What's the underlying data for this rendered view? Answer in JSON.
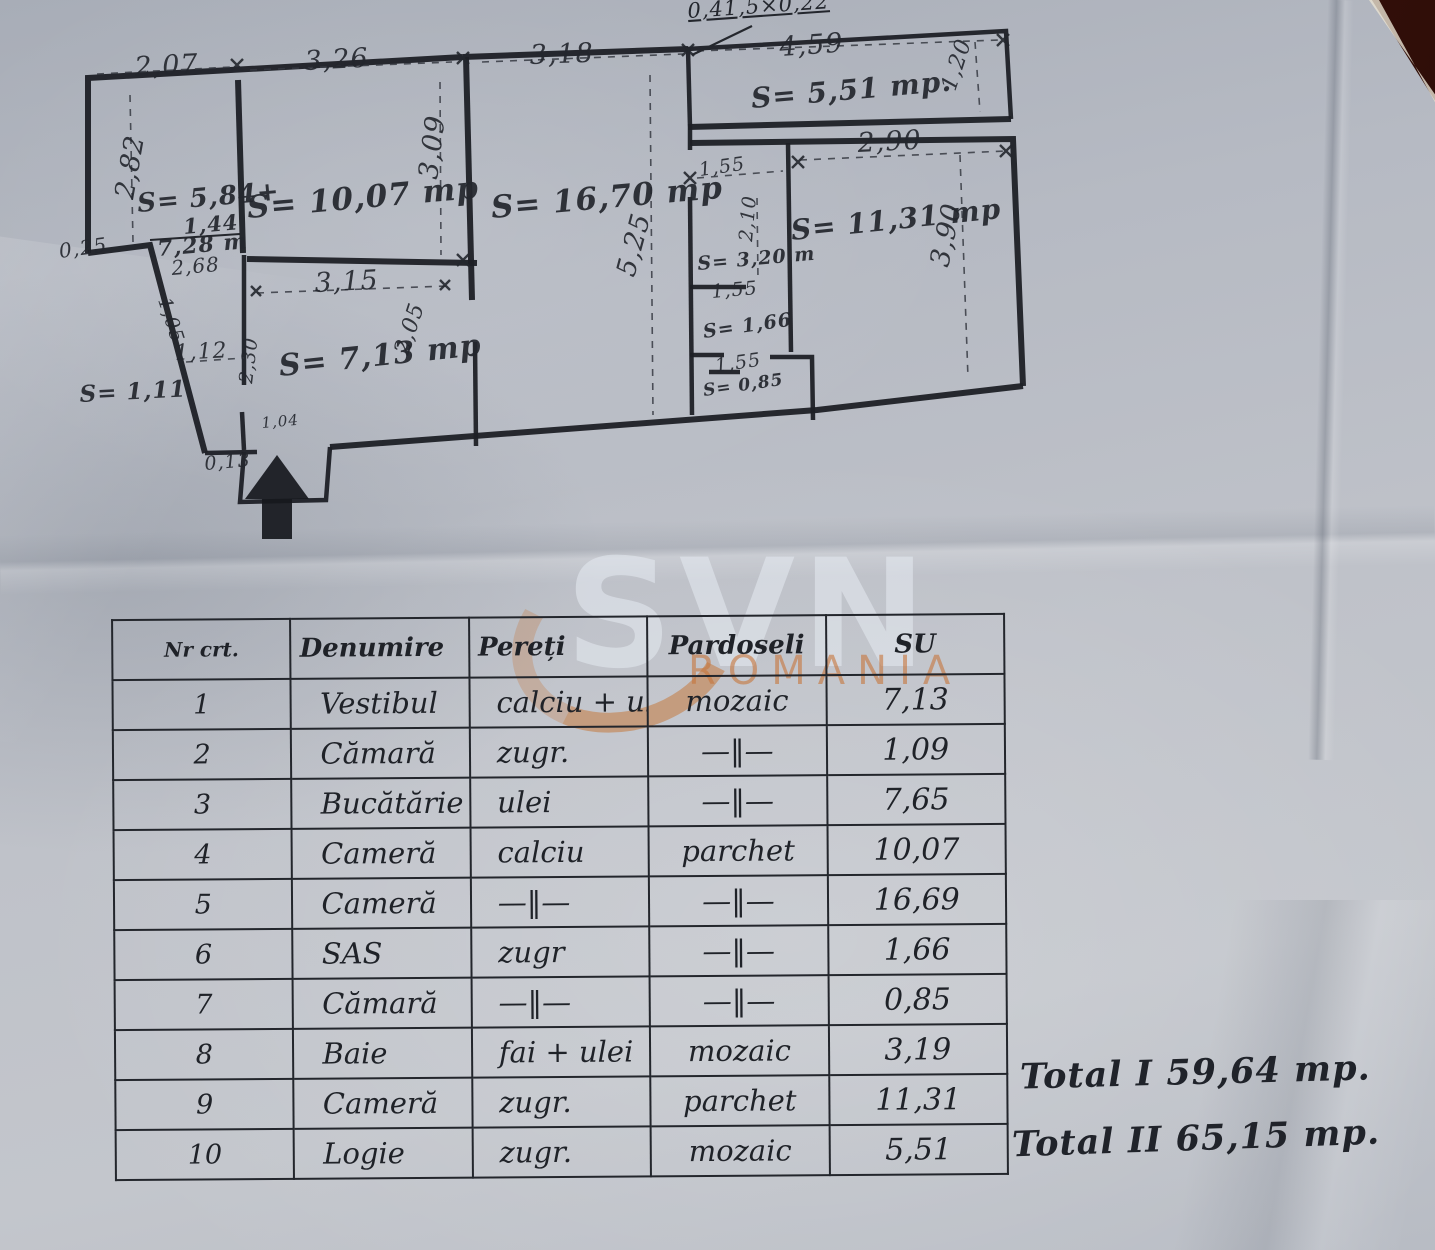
{
  "colors": {
    "paper": "#bcc0c8",
    "ink": "#1d2026",
    "backdrop_wedge": "#451710",
    "watermark_orange": "#c5793f",
    "watermark_gray": "#e6ebf3"
  },
  "watermark": {
    "brand": "SVN",
    "region": "ROMANIA"
  },
  "floor_plan": {
    "entrance_marker": "entrance-arrow",
    "labels": [
      {
        "t": "2,07",
        "x": 135,
        "y": 76,
        "r": -3,
        "s": 27,
        "c": "dim"
      },
      {
        "t": "3,26",
        "x": 305,
        "y": 70,
        "r": -3,
        "s": 27,
        "c": "dim"
      },
      {
        "t": "3,18",
        "x": 530,
        "y": 64,
        "r": -2,
        "s": 27,
        "c": "dim"
      },
      {
        "t": "4,59",
        "x": 780,
        "y": 56,
        "r": -4,
        "s": 27,
        "c": "dim"
      },
      {
        "t": "0,41,5×0,22",
        "x": 688,
        "y": 18,
        "r": -4,
        "s": 21,
        "c": "callout"
      },
      {
        "t": "2,82",
        "x": 133,
        "y": 200,
        "r": -80,
        "s": 27,
        "c": "dim"
      },
      {
        "t": "3,09",
        "x": 437,
        "y": 180,
        "r": -83,
        "s": 27,
        "c": "dim"
      },
      {
        "t": "1,20",
        "x": 955,
        "y": 92,
        "r": -72,
        "s": 22,
        "c": "dim"
      },
      {
        "t": "2,90",
        "x": 858,
        "y": 152,
        "r": -3,
        "s": 27,
        "c": "dim"
      },
      {
        "t": "1,55",
        "x": 700,
        "y": 176,
        "r": -8,
        "s": 19,
        "c": "dim"
      },
      {
        "t": "2,10",
        "x": 752,
        "y": 242,
        "r": -85,
        "s": 19,
        "c": "dim"
      },
      {
        "t": "3,90",
        "x": 948,
        "y": 268,
        "r": -78,
        "s": 27,
        "c": "dim"
      },
      {
        "t": "5,25",
        "x": 634,
        "y": 278,
        "r": -75,
        "s": 27,
        "c": "dim"
      },
      {
        "t": "3,15",
        "x": 315,
        "y": 292,
        "r": -3,
        "s": 27,
        "c": "dim"
      },
      {
        "t": "1,55",
        "x": 712,
        "y": 298,
        "r": -5,
        "s": 19,
        "c": "dim"
      },
      {
        "t": "1,55",
        "x": 716,
        "y": 372,
        "r": -8,
        "s": 19,
        "c": "dim"
      },
      {
        "t": "1,12",
        "x": 175,
        "y": 360,
        "r": -3,
        "s": 22,
        "c": "dim"
      },
      {
        "t": "2,30",
        "x": 252,
        "y": 384,
        "r": -83,
        "s": 19,
        "c": "dim"
      },
      {
        "t": "2,05",
        "x": 408,
        "y": 356,
        "r": -72,
        "s": 22,
        "c": "dim"
      },
      {
        "t": "1,05",
        "x": 158,
        "y": 300,
        "r": 72,
        "s": 19,
        "c": "dim"
      },
      {
        "t": "0,25",
        "x": 60,
        "y": 258,
        "r": -8,
        "s": 20,
        "c": "dim"
      },
      {
        "t": "0,13",
        "x": 205,
        "y": 470,
        "r": -5,
        "s": 19,
        "c": "dim"
      },
      {
        "t": "1,04",
        "x": 262,
        "y": 428,
        "r": -5,
        "s": 15,
        "c": "dim"
      },
      {
        "t": "S= 5,84+",
        "x": 138,
        "y": 212,
        "r": -5,
        "s": 26,
        "c": "area"
      },
      {
        "t": "1,44",
        "x": 184,
        "y": 234,
        "r": -5,
        "s": 21,
        "c": "area"
      },
      {
        "t": "7,28 m",
        "x": 158,
        "y": 256,
        "r": -5,
        "s": 22,
        "c": "area"
      },
      {
        "t": "2,68",
        "x": 172,
        "y": 275,
        "r": -5,
        "s": 20,
        "c": "dim"
      },
      {
        "t": "S= 10,07 mp",
        "x": 248,
        "y": 218,
        "r": -5,
        "s": 31,
        "c": "area"
      },
      {
        "t": "S= 16,70 mp",
        "x": 492,
        "y": 218,
        "r": -5,
        "s": 31,
        "c": "area"
      },
      {
        "t": "S= 5,51 mp.",
        "x": 752,
        "y": 108,
        "r": -5,
        "s": 28,
        "c": "area"
      },
      {
        "t": "S= 11,31 mp",
        "x": 792,
        "y": 240,
        "r": -6,
        "s": 28,
        "c": "area"
      },
      {
        "t": "S= 3,20 m",
        "x": 698,
        "y": 270,
        "r": -5,
        "s": 19,
        "c": "area"
      },
      {
        "t": "S= 1,66",
        "x": 704,
        "y": 338,
        "r": -8,
        "s": 19,
        "c": "area"
      },
      {
        "t": "S= 0,85",
        "x": 704,
        "y": 396,
        "r": -8,
        "s": 17,
        "c": "area"
      },
      {
        "t": "S= 7,13 mp",
        "x": 280,
        "y": 376,
        "r": -6,
        "s": 30,
        "c": "area"
      },
      {
        "t": "S= 1,11",
        "x": 80,
        "y": 402,
        "r": -3,
        "s": 23,
        "c": "area"
      }
    ]
  },
  "table": {
    "headers": [
      "Nr crt.",
      "Denumire",
      "Pereți",
      "Pardoseli",
      "SU"
    ],
    "rows": [
      [
        "1",
        "Vestibul",
        "calciu + ulei",
        "mozaic",
        "7,13"
      ],
      [
        "2",
        "Cămară",
        "zugr.",
        "—‖—",
        "1,09"
      ],
      [
        "3",
        "Bucătărie",
        "ulei",
        "—‖—",
        "7,65"
      ],
      [
        "4",
        "Cameră",
        "calciu",
        "parchet",
        "10,07"
      ],
      [
        "5",
        "Cameră",
        "—‖—",
        "—‖—",
        "16,69"
      ],
      [
        "6",
        "SAS",
        "zugr",
        "—‖—",
        "1,66"
      ],
      [
        "7",
        "Cămară",
        "—‖—",
        "—‖—",
        "0,85"
      ],
      [
        "8",
        "Baie",
        "fai + ulei",
        "mozaic",
        "3,19"
      ],
      [
        "9",
        "Cameră",
        "zugr.",
        "parchet",
        "11,31"
      ],
      [
        "10",
        "Logie",
        "zugr.",
        "mozaic",
        "5,51"
      ]
    ]
  },
  "totals": {
    "total_1": "Total I 59,64 mp.",
    "total_2": "Total II 65,15 mp."
  }
}
